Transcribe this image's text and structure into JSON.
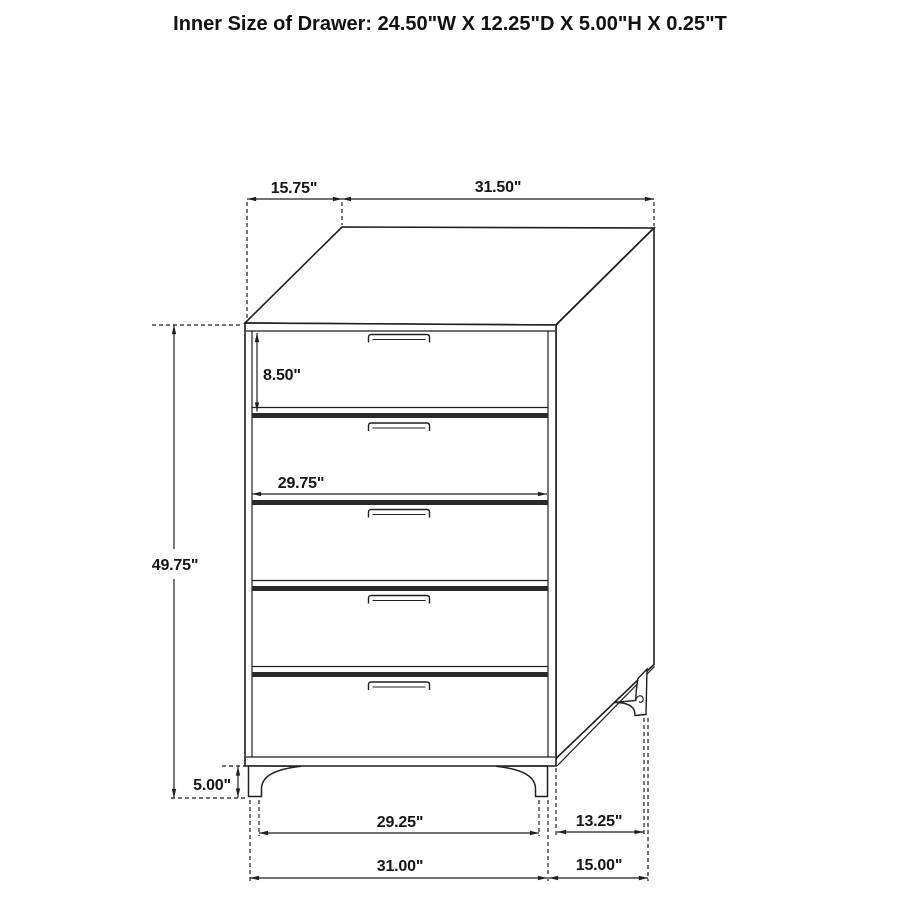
{
  "header": {
    "title": "Inner Size of Drawer: 24.50\"W X 12.25\"D X 5.00\"H X 0.25\"T"
  },
  "colors": {
    "ink": "#1f1f1f",
    "divider_fill": "#2a2a2a",
    "background": "#ffffff"
  },
  "figure": {
    "type": "furniture-dimension-diagram",
    "subject": "five-drawer-chest",
    "drawer_count": 5,
    "dimensions": {
      "top_depth": "15.75\"",
      "top_width": "31.50\"",
      "top_drawer_height": "8.50\"",
      "drawer_front_width": "29.75\"",
      "overall_height": "49.75\"",
      "leg_height": "5.00\"",
      "front_leg_span_inner": "29.25\"",
      "side_leg_span_inner": "13.25\"",
      "front_width_overall": "31.00\"",
      "side_depth_overall": "15.00\""
    }
  }
}
